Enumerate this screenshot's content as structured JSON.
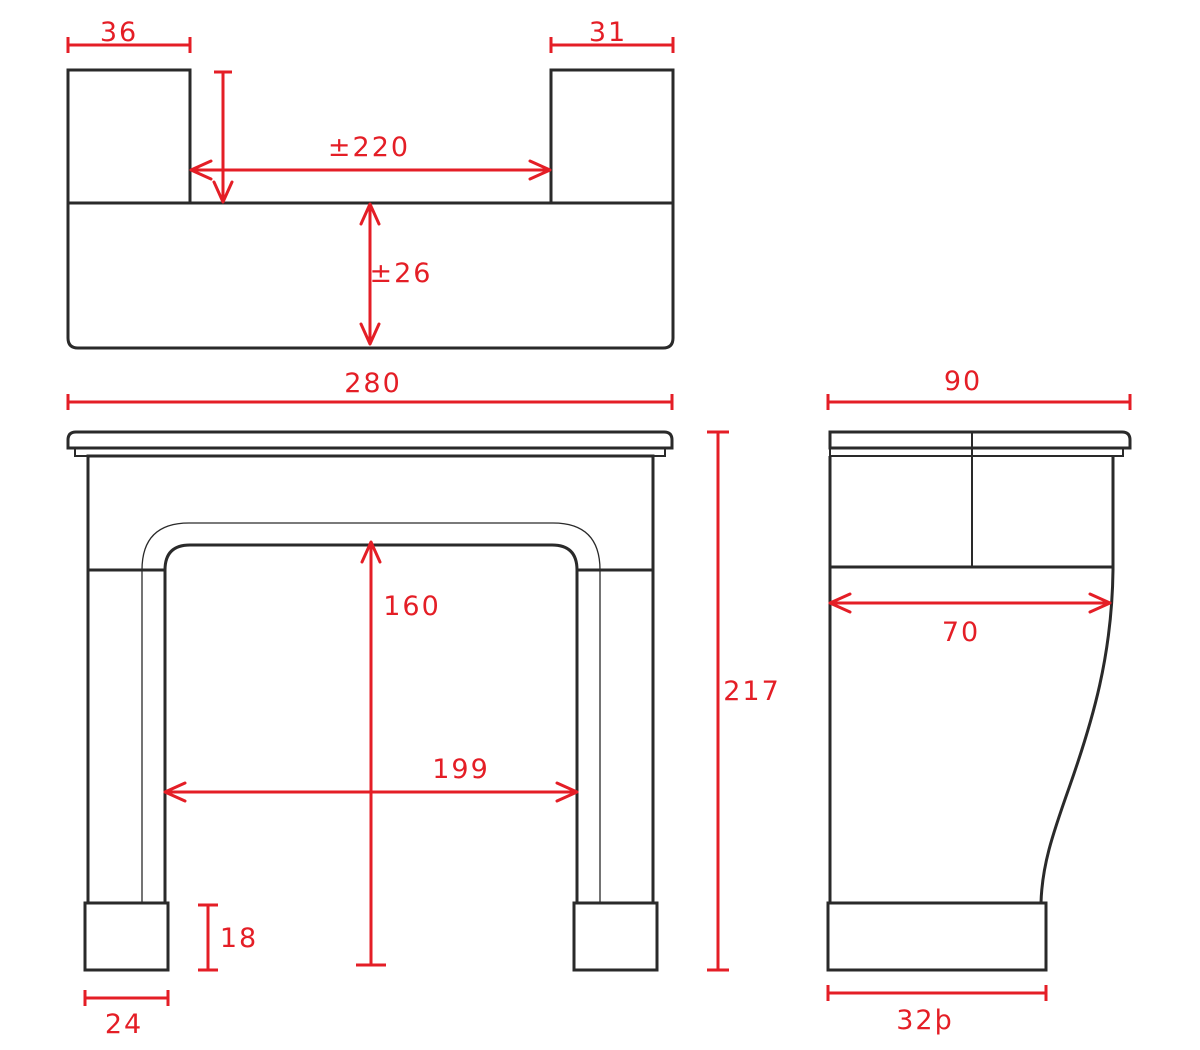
{
  "drawing": {
    "type": "technical-dimension-drawing",
    "subject": "fireplace mantel surround",
    "background_color": "#ffffff",
    "line_color": "#2a2a2a",
    "dimension_color": "#e41e26"
  },
  "dimensions": {
    "top": {
      "left_block_width": "36",
      "right_block_width": "31",
      "between_blocks": "±220",
      "base_depth": "±26"
    },
    "front": {
      "overall_width": "280",
      "opening_height": "160",
      "opening_width": "199",
      "foot_height": "18",
      "foot_width": "24",
      "overall_height": "217"
    },
    "side": {
      "overall_depth": "90",
      "body_depth": "70",
      "foot_depth": "32þ"
    }
  }
}
